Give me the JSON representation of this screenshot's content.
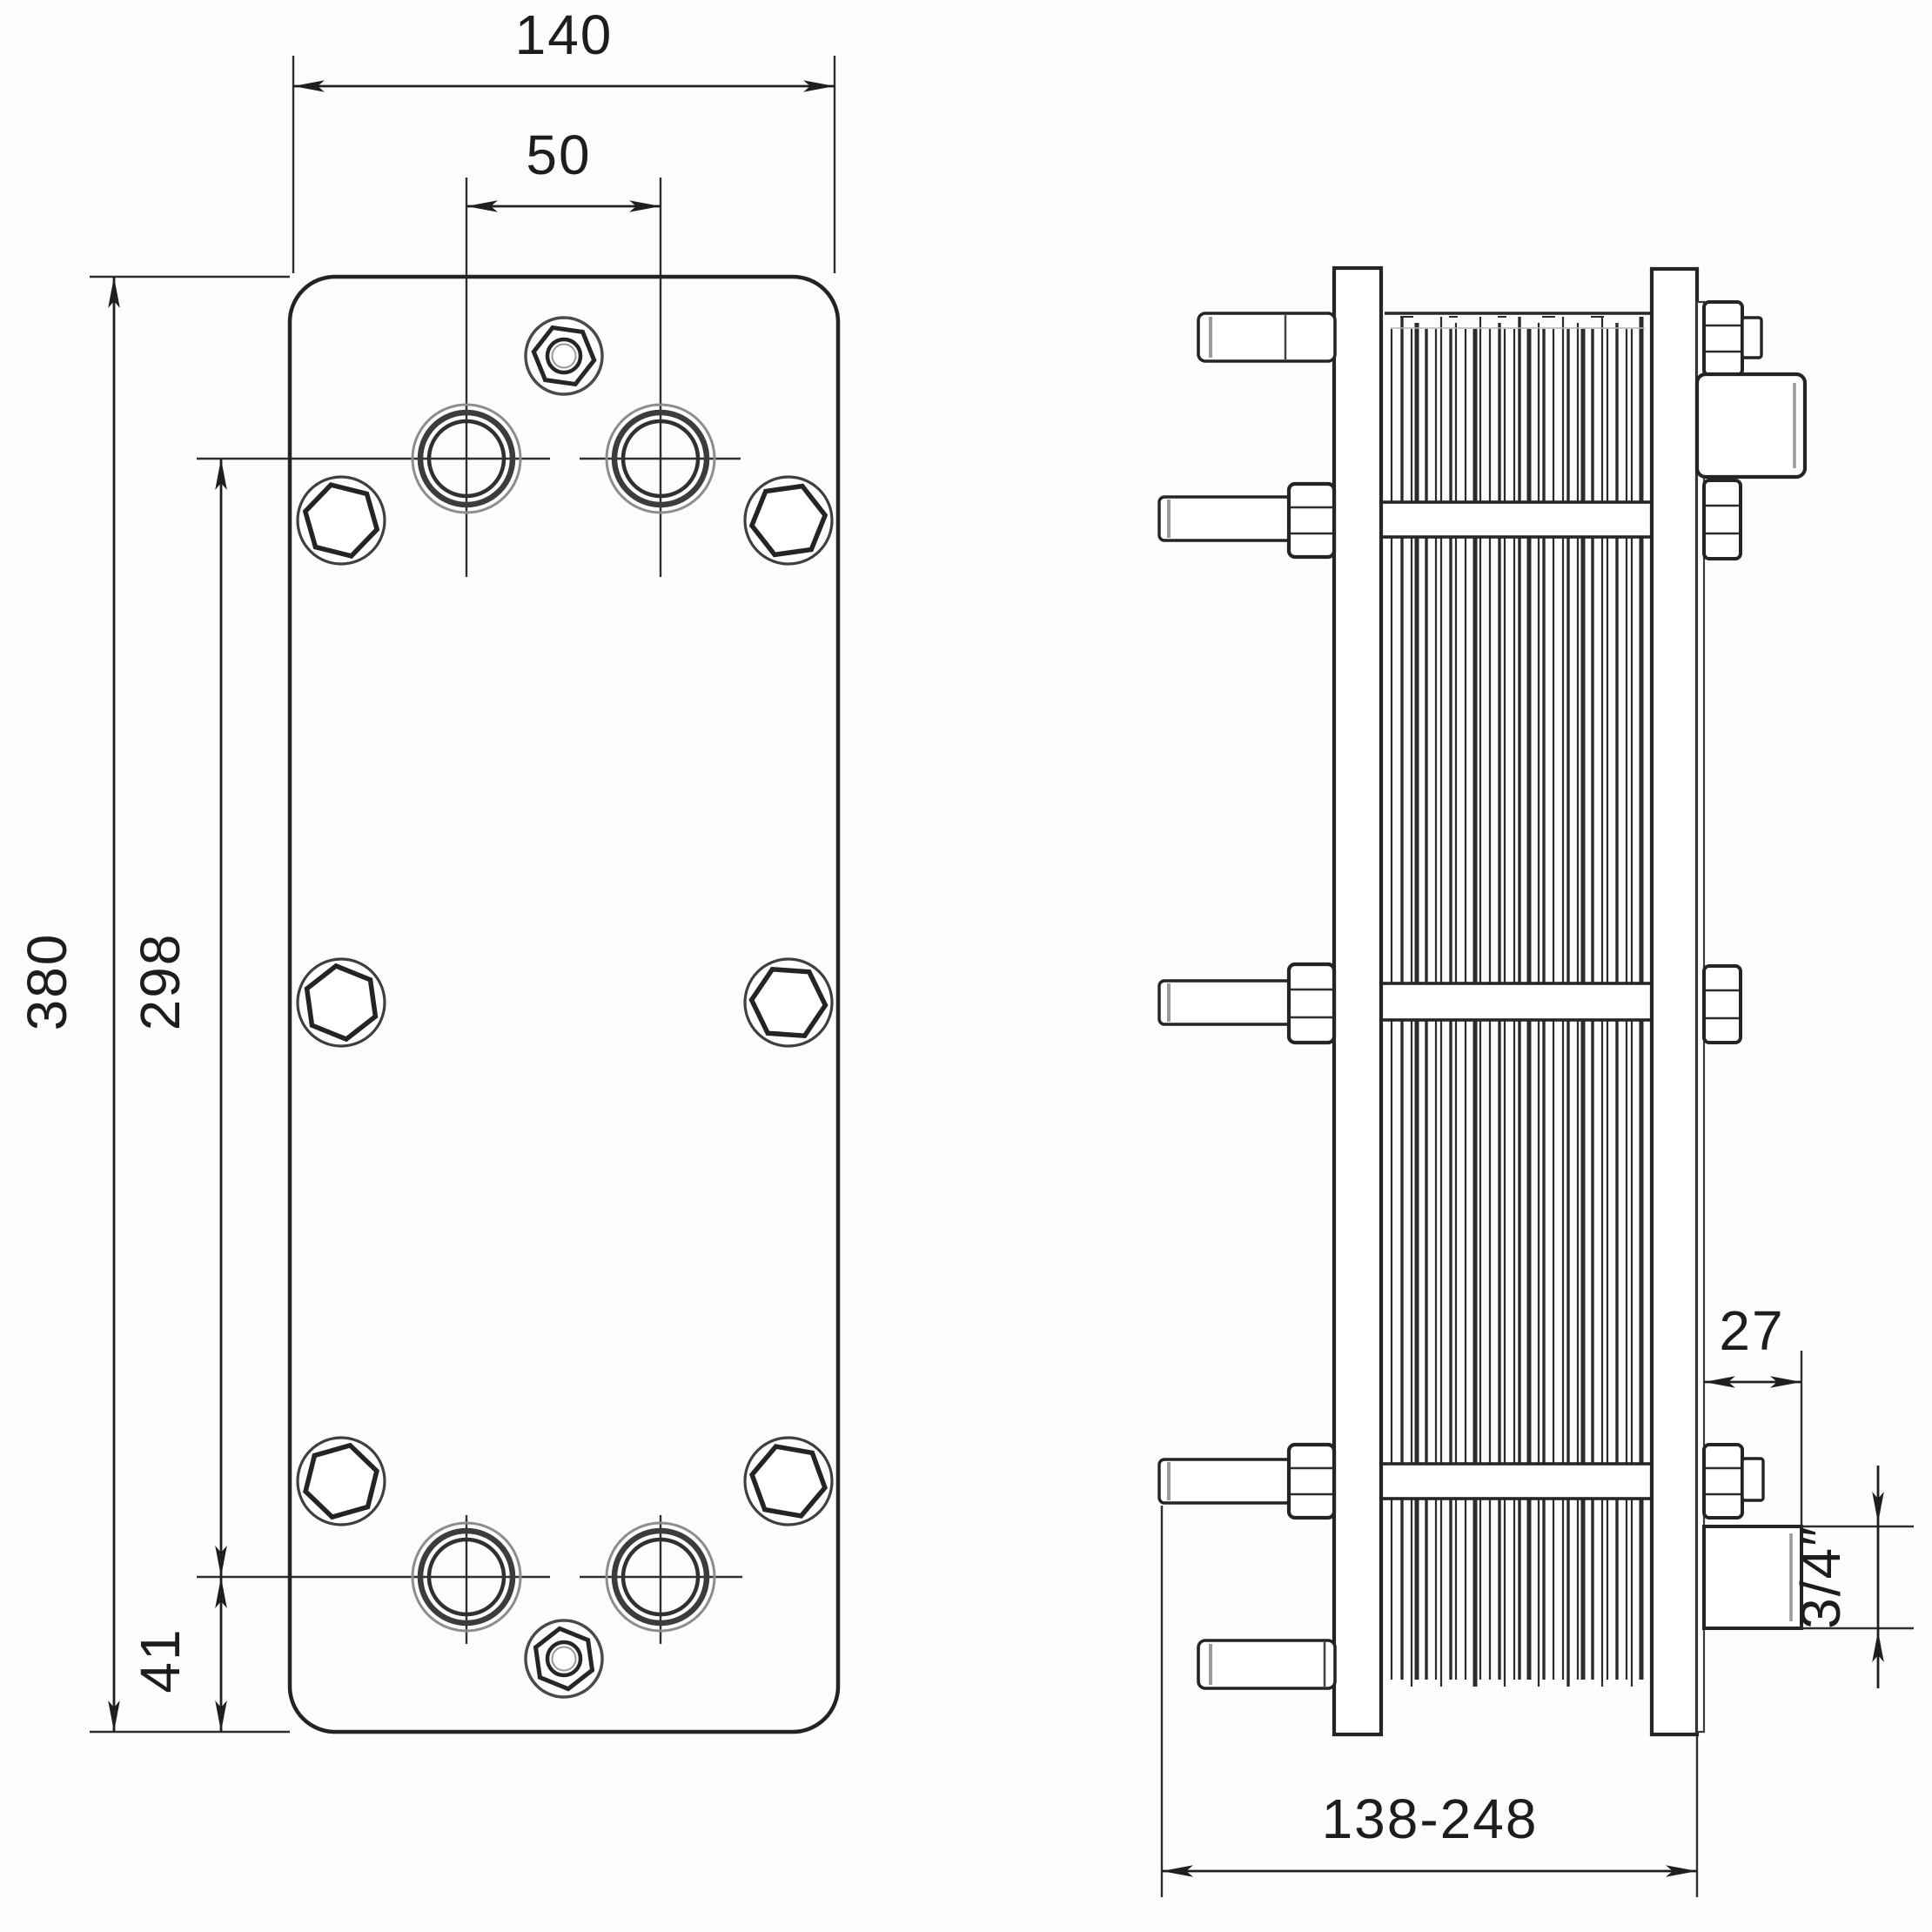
{
  "colors": {
    "background": "#fdfdfd",
    "ink": "#232323",
    "medium_ink": "#3c3c3c",
    "light_ink": "#8d8d8d"
  },
  "front_view": {
    "dimensions": {
      "overall_width": "140",
      "port_spacing_horizontal": "50",
      "overall_height": "380",
      "port_spacing_vertical": "298",
      "port_offset_bottom": "41"
    }
  },
  "side_view": {
    "dimensions": {
      "connection_offset": "27",
      "connection_size": "3/4″",
      "pack_length_range": "138-248"
    }
  }
}
